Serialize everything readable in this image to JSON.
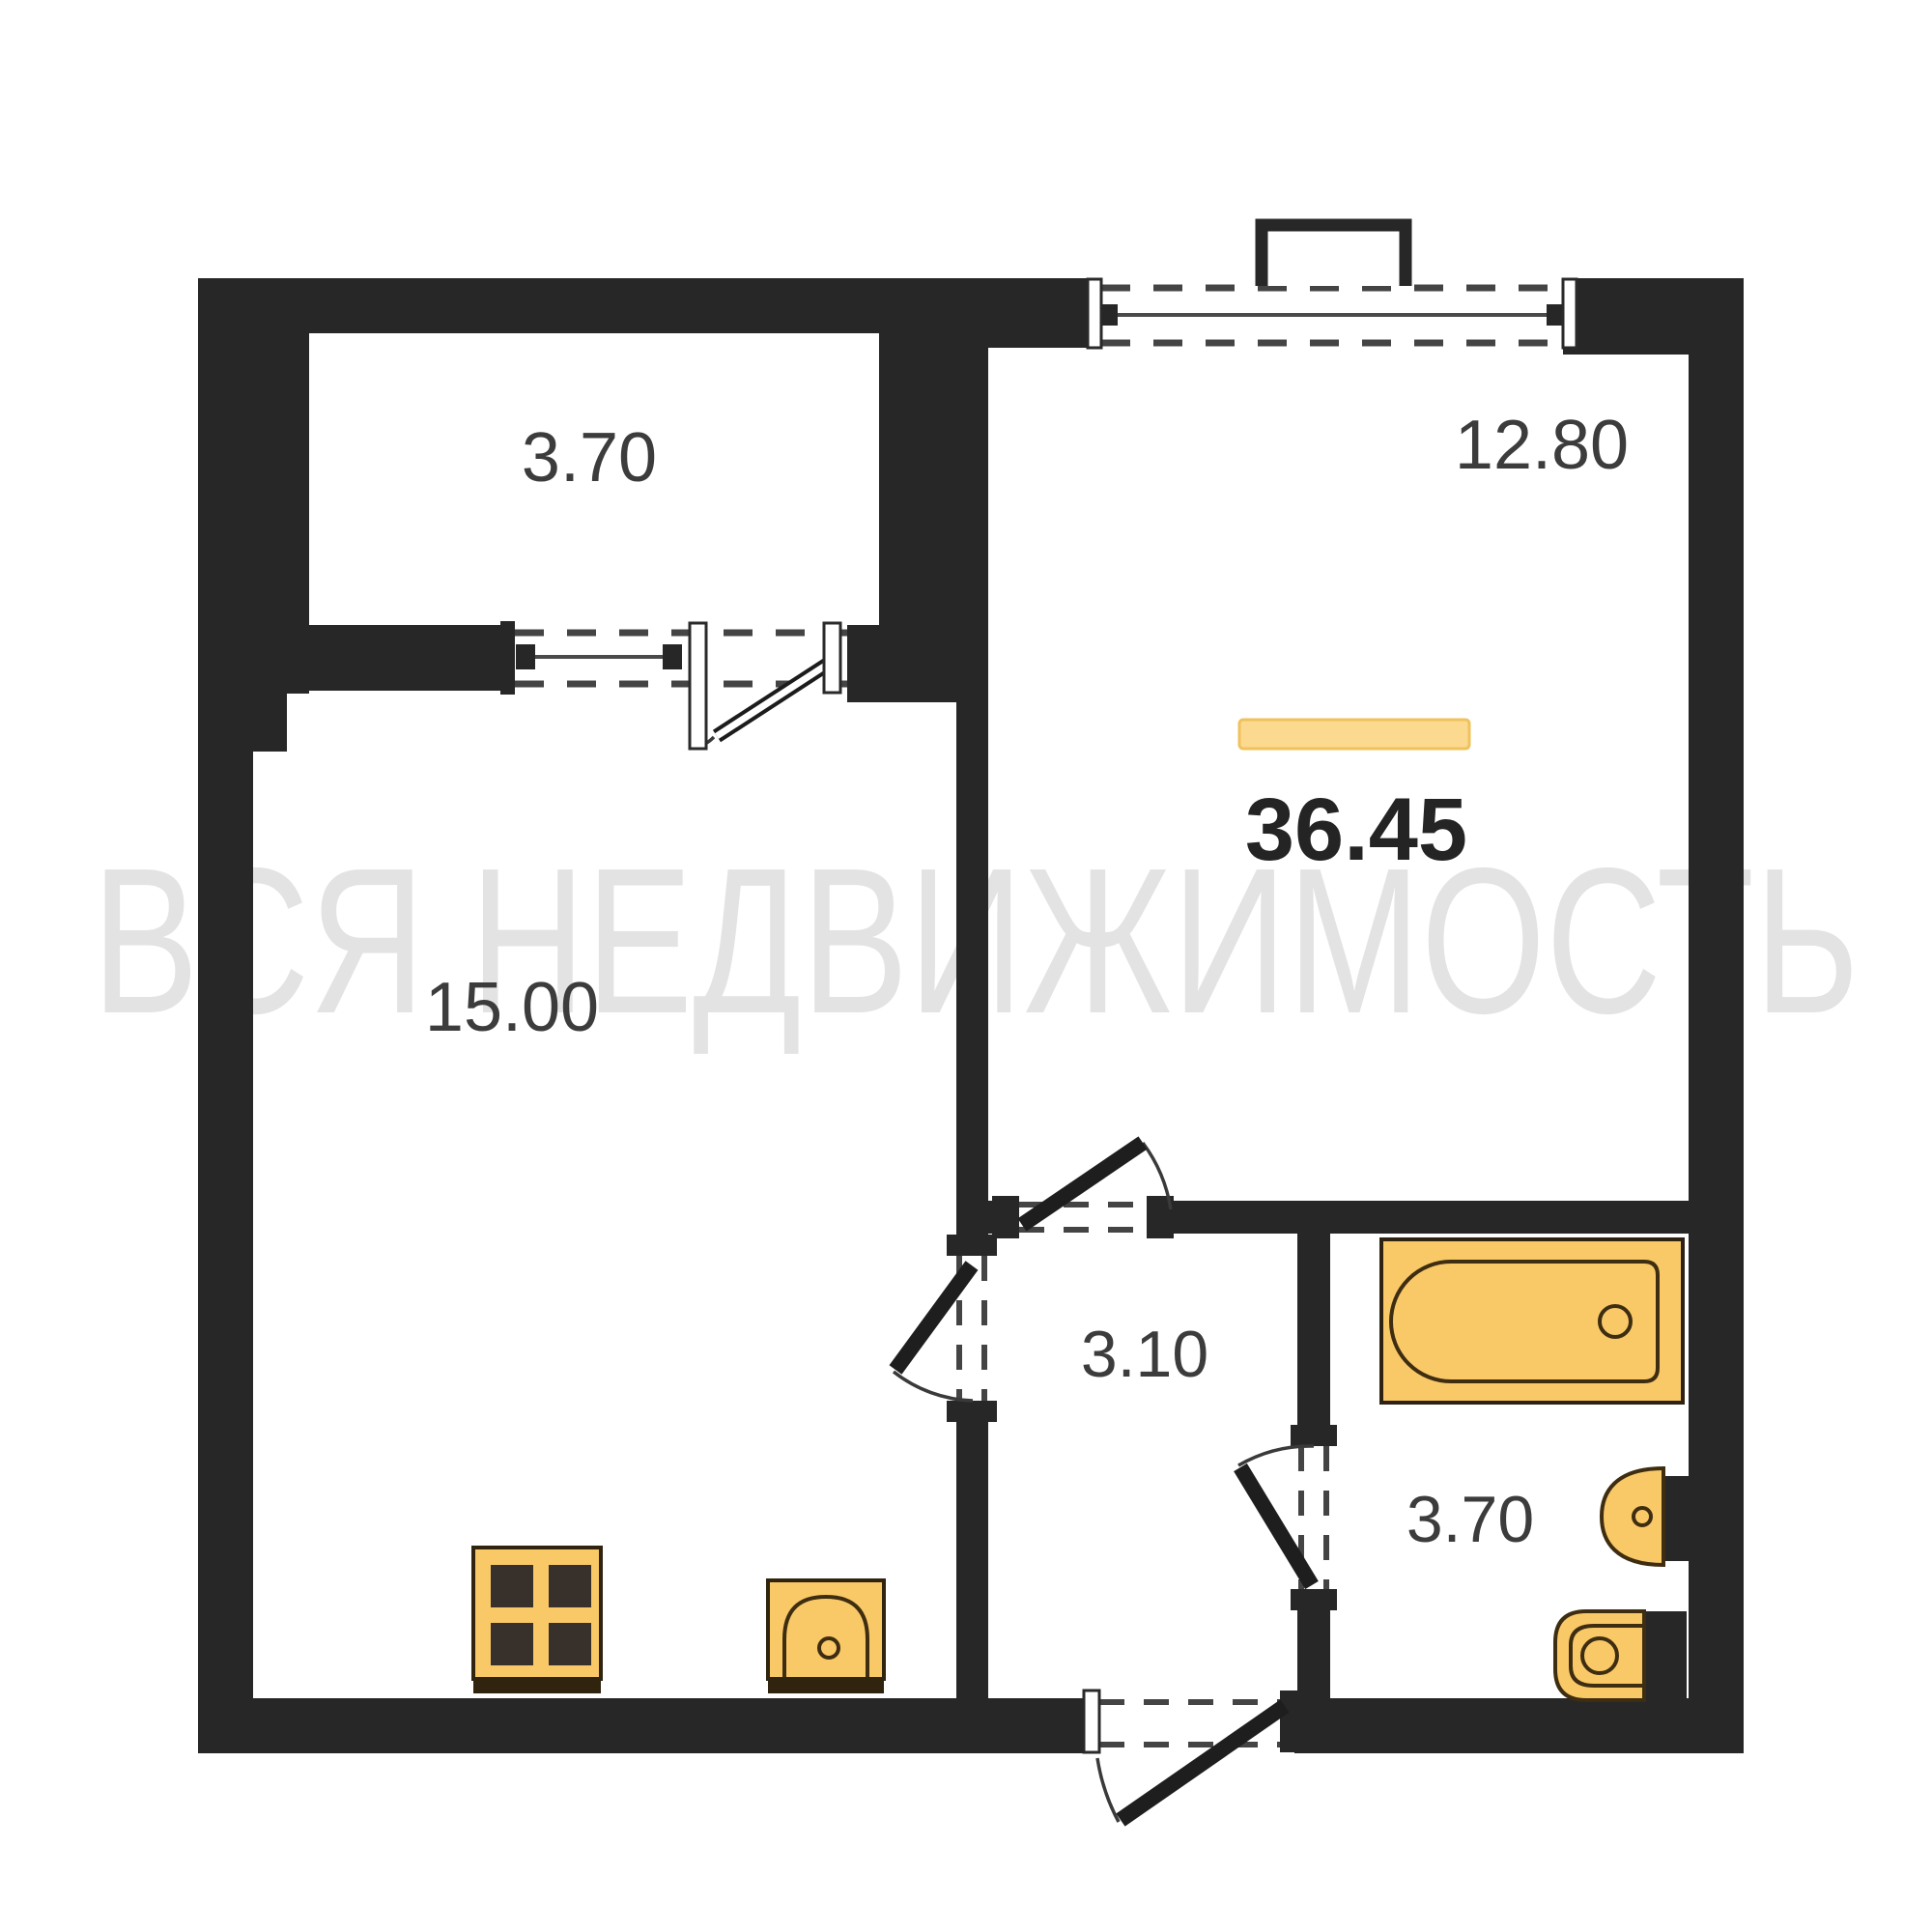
{
  "watermark": {
    "text": "ВСЯ НЕДВИЖИМОСТЬ",
    "color": "#E3E3E3"
  },
  "summary": {
    "total_area": "36.45",
    "highlight_fill": "#FBD98F",
    "highlight_border": "#EFC25B"
  },
  "rooms": {
    "balcony": {
      "area": "3.70"
    },
    "living_room": {
      "area": "12.80"
    },
    "kitchen_living": {
      "area": "15.00"
    },
    "hallway": {
      "area": "3.10"
    },
    "bathroom": {
      "area": "3.70"
    }
  },
  "fixtures": {
    "items": [
      "bathtub",
      "bathroom-sink",
      "toilet",
      "stove",
      "kitchen-sink"
    ],
    "fill": "#F9C967",
    "outline": "#3E2D11",
    "burner_fill": "#38302A"
  },
  "colors": {
    "wall": "#272727",
    "door": "#1E1E1E",
    "label": "#3C3C3C",
    "total_label": "#242424",
    "glass_line": "#4A4A4A",
    "dash": "#444444"
  }
}
